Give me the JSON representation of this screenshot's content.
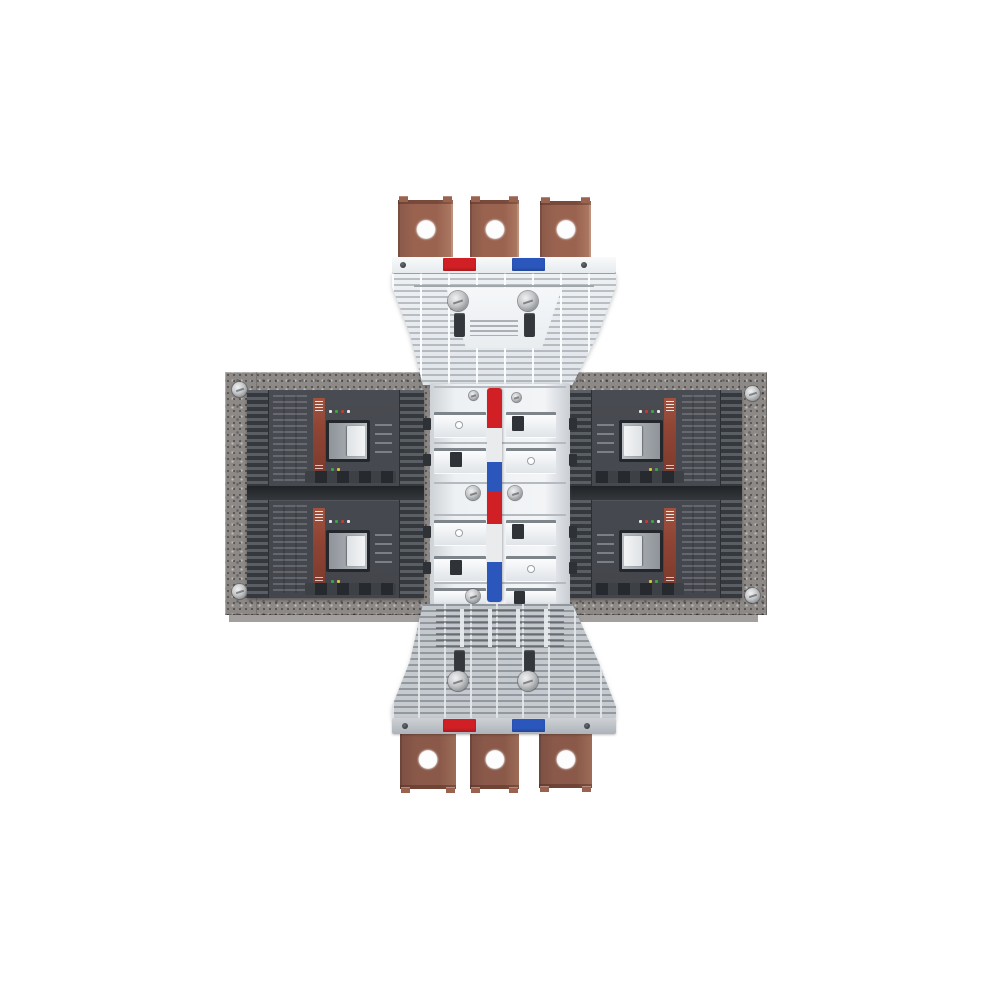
{
  "scene": {
    "background": "#ffffff"
  },
  "colors": {
    "bg": "#ffffff",
    "copper": "#9a6350",
    "copper_dark": "#6e4034",
    "copper_shadow": "#8a5949",
    "adapter_white": "#eef1f4",
    "adapter_gray": "#c6cbd0",
    "plate_gray": "#8d8987",
    "breaker_body": "#43464c",
    "label_red": "#8f4434",
    "toggle_light": "#f3f5f6",
    "fin_light": "#5a5e65",
    "fin_dark": "#35383d",
    "phase_red": "#d02025",
    "phase_white": "#e9ebed",
    "phase_blue": "#2b57bd"
  },
  "top_adapter": {
    "terminal_count": 3,
    "phase_markers": [
      "phase_red",
      "phase_blue"
    ]
  },
  "bottom_adapter": {
    "terminal_count": 3,
    "phase_markers": [
      "phase_red",
      "phase_blue"
    ]
  },
  "center_column": {
    "stripe_segments": [
      {
        "color": "phase_red",
        "height": 40
      },
      {
        "color": "phase_white",
        "height": 34
      },
      {
        "color": "phase_blue",
        "height": 30
      },
      {
        "color": "phase_red",
        "height": 32
      },
      {
        "color": "phase_white",
        "height": 38
      },
      {
        "color": "phase_blue",
        "height": 40
      }
    ]
  },
  "breakers": {
    "count": 4,
    "rows": 2,
    "columns": 2
  },
  "mounting_plates": {
    "count": 2,
    "corner_screws_per_plate": 2
  }
}
